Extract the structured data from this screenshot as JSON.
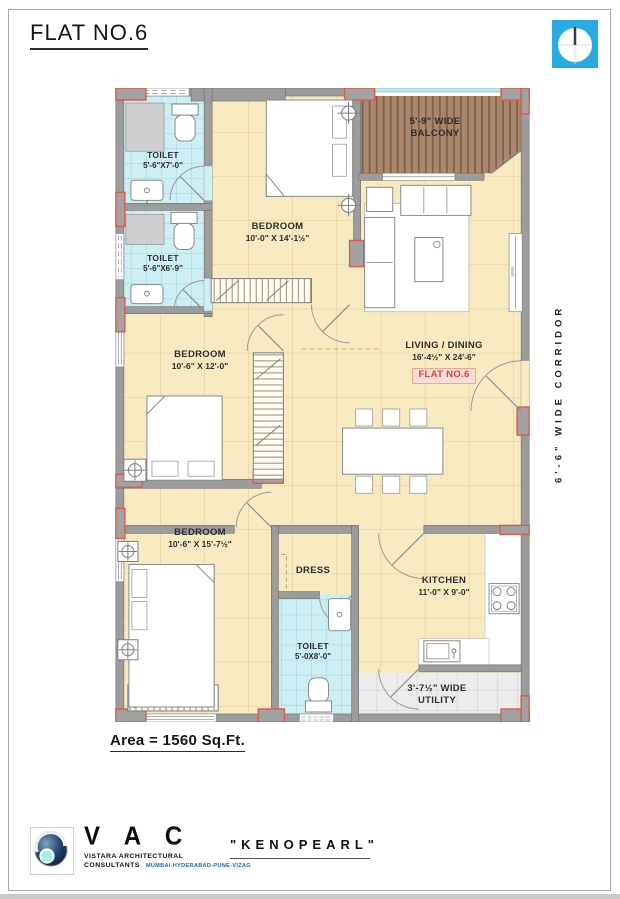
{
  "title": "FLAT NO.6",
  "area_note": "Area = 1560 Sq.Ft.",
  "corridor_label": "6'-6\" WIDE CORRIDOR",
  "rooms": {
    "toilet_top": {
      "name": "TOILET",
      "dims": "5'-6\"X7'-0\""
    },
    "toilet_mid": {
      "name": "TOILET",
      "dims": "5'-6\"X6'-9\""
    },
    "bedroom_top": {
      "name": "BEDROOM",
      "dims": "10'-0\" X 14'-1½\""
    },
    "balcony": {
      "line1": "5'-9\" WIDE",
      "line2": "BALCONY"
    },
    "living": {
      "name": "LIVING / DINING",
      "dims": "16'-4½\" X 24'-6\"",
      "flat_tag": "FLAT NO.6"
    },
    "bedroom_mid": {
      "name": "BEDROOM",
      "dims": "10'-6\" X 12'-0\""
    },
    "bedroom_bottom": {
      "name": "BEDROOM",
      "dims": "10'-6\" X 15'-7½\""
    },
    "dress": {
      "name": "DRESS"
    },
    "toilet_bottom": {
      "name": "TOILET",
      "dims": "5'-0X8'-0\""
    },
    "kitchen": {
      "name": "KITCHEN",
      "dims": "11'-0\" X 9'-0\""
    },
    "utility": {
      "line1": "3'-7½\" WIDE",
      "line2": "UTILITY"
    }
  },
  "footer": {
    "brand": "V A C",
    "firm_line1": "VISTARA ARCHITECTURAL",
    "firm_line2": "CONSULTANTS",
    "cities": "MUMBAI-HYDERABAD-PUNE-VIZAG",
    "project": "\"KENOPEARL\""
  },
  "colors": {
    "floor": "#f7e9c0",
    "toilet_floor": "#cdeef2",
    "balcony_floor": "#a9876d",
    "wall": "#9c9c9c",
    "column_accent": "#e05a4a",
    "flat_tag_red": "#d9452e",
    "north_blue": "#29abe2"
  }
}
